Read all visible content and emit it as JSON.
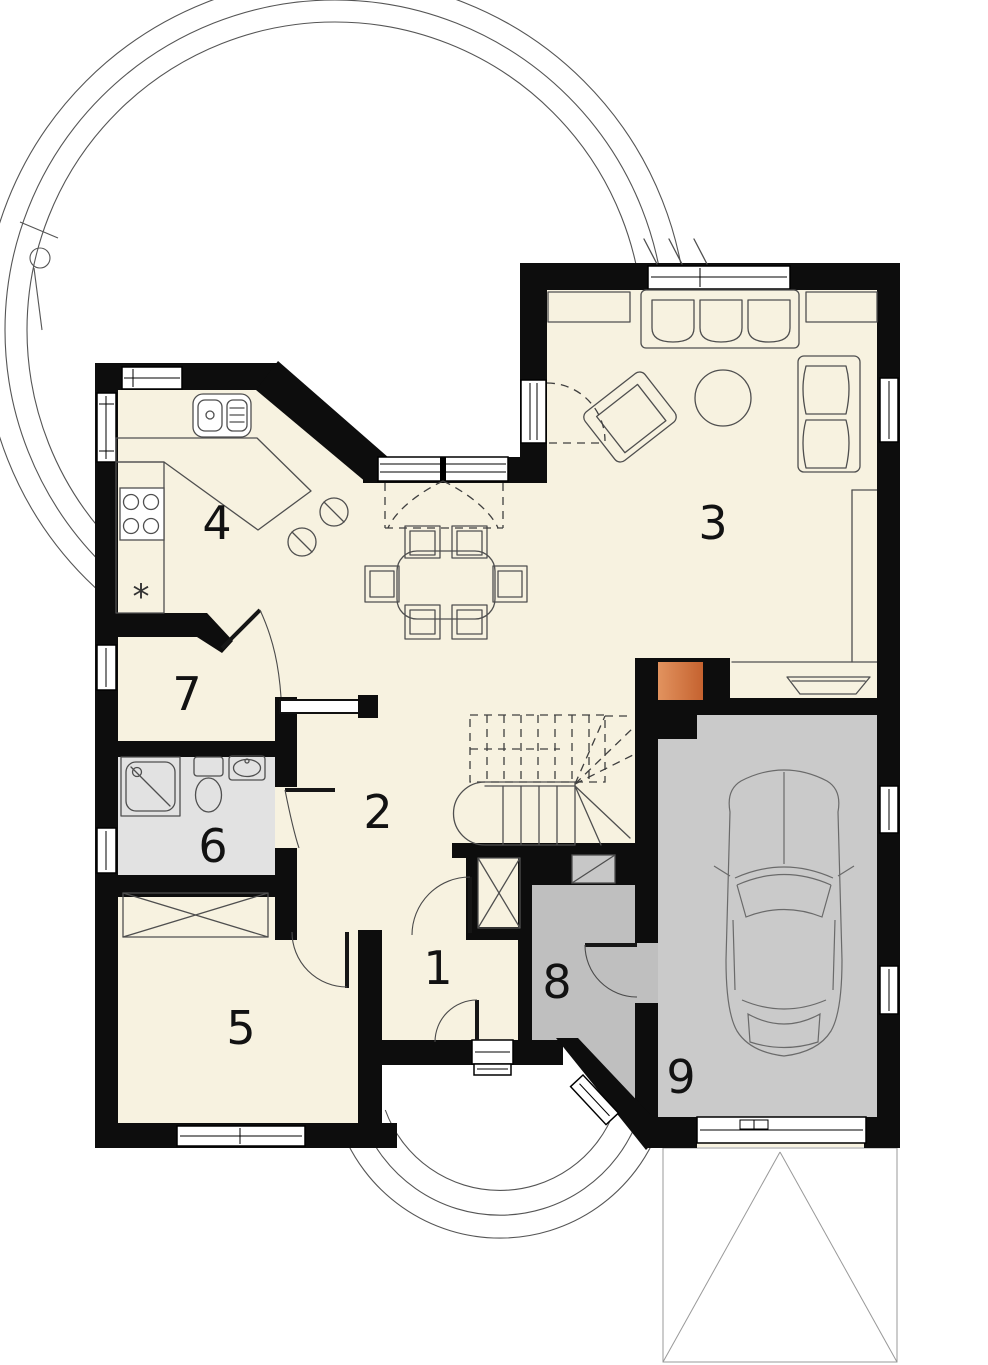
{
  "plan": {
    "type": "house-ground-floor-plan",
    "room_labels": [
      {
        "label": "1",
        "x": 438,
        "y": 968
      },
      {
        "label": "2",
        "x": 378,
        "y": 812
      },
      {
        "label": "3",
        "x": 713,
        "y": 523
      },
      {
        "label": "4",
        "x": 217,
        "y": 523
      },
      {
        "label": "5",
        "x": 241,
        "y": 1028
      },
      {
        "label": "6",
        "x": 213,
        "y": 846
      },
      {
        "label": "7",
        "x": 187,
        "y": 694
      },
      {
        "label": "8",
        "x": 557,
        "y": 982
      },
      {
        "label": "9",
        "x": 681,
        "y": 1077
      }
    ],
    "kitchen_symbol": {
      "label": "*"
    },
    "palette": {
      "wall": "#0d0d0d",
      "floor": "#f7f2e0",
      "bathroom_floor": "#e2e2e2",
      "utility_floor": "#bfbfbf",
      "garage_floor": "#cacaca",
      "chimney_light": "#e2935f",
      "chimney_dark": "#c5622f",
      "line": "#4f4f4f",
      "site_line": "#555555"
    }
  }
}
